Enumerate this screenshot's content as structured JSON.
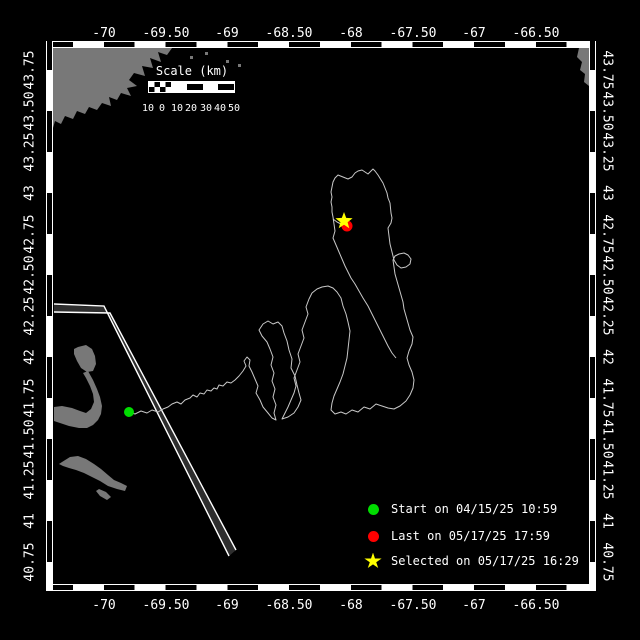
{
  "colors": {
    "background": "#000000",
    "frame": "#ffffff",
    "land": "#787878",
    "ocean": "#000000",
    "track": "#c8c8c8",
    "lane_fill": "#2e2e2e",
    "lane_line": "#ffffff",
    "text": "#ffffff",
    "start": "#00dd00",
    "last": "#ff0000",
    "selected": "#ffff00"
  },
  "axes": {
    "lon_ticks": [
      {
        "label": "-70",
        "x": 104
      },
      {
        "label": "-69.50",
        "x": 166
      },
      {
        "label": "-69",
        "x": 227
      },
      {
        "label": "-68.50",
        "x": 289
      },
      {
        "label": "-68",
        "x": 351
      },
      {
        "label": "-67.50",
        "x": 413
      },
      {
        "label": "-67",
        "x": 474
      },
      {
        "label": "-66.50",
        "x": 536
      }
    ],
    "lat_ticks": [
      {
        "label": "43.75",
        "y": 70
      },
      {
        "label": "43.50",
        "y": 111
      },
      {
        "label": "43.25",
        "y": 152
      },
      {
        "label": "43",
        "y": 193
      },
      {
        "label": "42.75",
        "y": 234
      },
      {
        "label": "42.50",
        "y": 275
      },
      {
        "label": "42.25",
        "y": 316
      },
      {
        "label": "42",
        "y": 357
      },
      {
        "label": "41.75",
        "y": 398
      },
      {
        "label": "41.50",
        "y": 439
      },
      {
        "label": "41.25",
        "y": 480
      },
      {
        "label": "41",
        "y": 521
      },
      {
        "label": "40.75",
        "y": 562
      }
    ]
  },
  "scalebar": {
    "title": "Scale (km)",
    "tick_labels": [
      {
        "label": "10",
        "x": 148
      },
      {
        "label": "0",
        "x": 162
      },
      {
        "label": "10",
        "x": 177
      },
      {
        "label": "20",
        "x": 191
      },
      {
        "label": "30",
        "x": 206
      },
      {
        "label": "40",
        "x": 220
      },
      {
        "label": "50",
        "x": 234
      }
    ]
  },
  "legend": {
    "items": [
      {
        "marker": "circle",
        "color": "#00dd00",
        "label": "Start on 04/15/25 10:59"
      },
      {
        "marker": "circle",
        "color": "#ff0000",
        "label": "Last on 05/17/25 17:59"
      },
      {
        "marker": "star",
        "color": "#ffff00",
        "label": "Selected on 05/17/25 16:29"
      }
    ]
  },
  "markers": {
    "start": {
      "x": 129,
      "y": 412
    },
    "last": {
      "x": 347,
      "y": 226
    },
    "selected": {
      "x": 344,
      "y": 221
    }
  },
  "map": {
    "frame": {
      "left": 53,
      "top": 48,
      "right": 589,
      "bottom": 584
    },
    "land": [
      "53,48 172,48 167,55 158,52 161,62 150,58 153,68 142,66 145,76 134,73 129,80 137,86 127,88 131,96 121,93 117,100 109,97 111,106 102,103 97,110 89,107 85,114 77,111 73,119 65,116 61,124 55,121 53,128",
      "589,48 589,86 584,82 585,74 580,70 582,62 577,57 579,48",
      "78,347 86,345 92,349 95,356 96,364 93,371 87,372 81,368 77,361 74,354 74,349",
      "83,373 88,371 93,380 97,389 100,397 102,406 101,414 98,420 93,425 87,428 79,428 69,426 60,423 54,421 54,407 62,406 72,408 80,411 86,413 91,409 94,402 93,394 90,386 86,378",
      "62,462 70,457 78,456 86,459 94,464 101,469 108,475 114,480 121,483 127,486 125,491 117,489 108,486 100,481 92,477 84,473 76,470 69,468 63,466 59,464",
      "99,489 106,492 111,497 107,500 100,496 96,491"
    ],
    "islands": [
      [
        226,
        60
      ],
      [
        238,
        64
      ],
      [
        205,
        52
      ],
      [
        190,
        56
      ]
    ],
    "lane": {
      "median": "54,305 104,307 229,556 236,550 110,313 54,312",
      "lines": [
        "54,304 104,306 229,556",
        "54,312 110,313 236,550"
      ]
    },
    "track": {
      "paths": [
        "129,412 135,414 141,411 147,413 152,410 158,412 163,409 168,407 172,404 177,402 181,404 185,400 190,398 193,395 197,397 200,393 204,394 207,390 211,391 214,388 217,389 219,385 223,386 227,382 231,383 235,380 239,376 243,371 246,366 244,361 247,357 250,360 249,366 252,372 255,379 258,386 256,393 260,400 263,407 268,413 272,418 276,420 274,413 276,405 273,397 275,389 272,381 274,373 271,365 273,357 270,349 267,342 262,336 259,330 263,324 268,321 273,324 278,322 282,326 284,333 287,341 289,350 292,359 291,368 295,376 297,385 299,393 301,400 298,407 294,413 288,417 282,419 285,413 288,407 291,400 294,393 296,386 294,378 297,370 300,362 298,354 301,346 304,338 302,330 305,322 308,314 306,307 309,299 312,293 317,289 322,287 328,286 333,288 337,292 341,298 343,306 346,314 348,322 350,331 349,340 348,349 347,358 345,366 343,374 340,382 337,389 334,396 332,403 331,410 335,414 341,412 346,414 352,410 358,412 364,407 370,409 376,404 382,406 388,408 394,409 400,406 406,401 410,395 413,388 414,380 412,372 409,365 407,358 409,351 412,344 413,337 410,330 408,323 406,316 404,309 403,302 401,295 399,288 397,281 395,274 394,267 393,260 395,256 399,254 404,253 408,255 411,259 410,264 406,267 401,268 397,265 394,260 392,252 390,244 389,236 388,228 391,223 392,218 391,213 390,203 388,198 387,193 385,188 383,183 378,175 375,171 373,169 368,174 365,172 362,170 358,171 355,173 352,177 348,179 343,177 338,175 335,178 333,182 332,187 331,192 332,197 331,202 332,207 332,212 333,217 334,224 335,231 333,238 336,245 339,252 342,259 345,266 348,272 351,278 355,284 359,291 363,298 368,306 372,314 376,322 380,330 384,338 388,346 392,353 396,358",
        "333,219 337,222 341,224 345,226 347,227"
      ]
    }
  }
}
